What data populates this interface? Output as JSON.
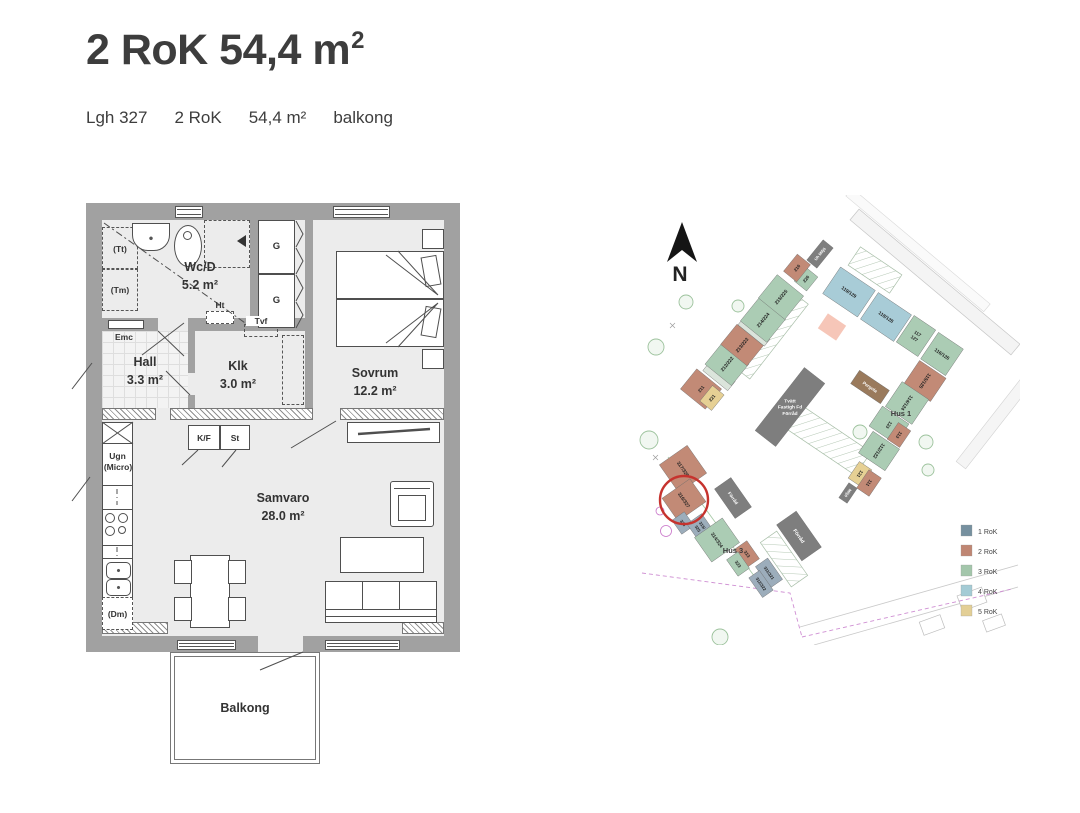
{
  "header": {
    "title_main": "2 RoK 54,4 m",
    "title_sup": "2",
    "meta": [
      "Lgh 327",
      "2 RoK",
      "54,4 m²",
      "balkong"
    ]
  },
  "floorplan": {
    "rooms": {
      "wcd": {
        "name": "Wc/D",
        "area": "5.2 m²"
      },
      "hall": {
        "name": "Hall",
        "area": "3.3 m²"
      },
      "klk": {
        "name": "Klk",
        "area": "3.0 m²"
      },
      "sovrum": {
        "name": "Sovrum",
        "area": "12.2 m²"
      },
      "samvaro": {
        "name": "Samvaro",
        "area": "28.0 m²"
      },
      "balkong": {
        "name": "Balkong"
      }
    },
    "labels": {
      "tt": "(Tt)",
      "tm": "(Tm)",
      "emc": "Emc",
      "ht": "Ht",
      "tvf": "Tvf",
      "g": "G",
      "kf": "K/F",
      "st": "St",
      "ugn": "Ugn",
      "micro": "(Micro)",
      "dm": "(Dm)"
    }
  },
  "siteplan": {
    "north": "N",
    "colors": {
      "rok1": "#9cadbb",
      "rok2": "#c28a76",
      "rok3": "#abccb4",
      "rok4": "#a8ccd7",
      "rok5": "#e6d094",
      "dark": "#7e7e7e",
      "pergola": "#9a7a5c",
      "connector": "#dbe4db"
    },
    "legend": [
      {
        "label": "1 RoK",
        "color": "#76909f"
      },
      {
        "label": "2 RoK",
        "color": "#bf8673"
      },
      {
        "label": "3 RoK",
        "color": "#a3c6ab"
      },
      {
        "label": "4 RoK",
        "color": "#a4cbd5"
      },
      {
        "label": "5 RoK",
        "color": "#e3cf96"
      }
    ],
    "area_labels": [
      {
        "text": "Hus 1",
        "x": 281,
        "y": 221
      },
      {
        "text": "Hus 3",
        "x": 113,
        "y": 358
      }
    ],
    "highlight": {
      "x": 64,
      "y": 305,
      "r": 24,
      "color": "#c6332e"
    },
    "buildings": [
      {
        "x": 81,
        "y": 194,
        "w": 26,
        "h": 32,
        "rot": -51,
        "c": "rok2",
        "lines": [
          "211"
        ],
        "fs": 4.5
      },
      {
        "x": 92,
        "y": 203,
        "w": 20,
        "h": 15,
        "rot": -51,
        "c": "rok5",
        "lines": [
          "221"
        ],
        "fs": 4.5
      },
      {
        "x": 99,
        "y": 181,
        "w": 12,
        "h": 32,
        "rot": -51,
        "c": "connector"
      },
      {
        "x": 107,
        "y": 169,
        "w": 28,
        "h": 34,
        "rot": -51,
        "c": "rok3",
        "lines": [
          "212/222"
        ],
        "fs": 4.8
      },
      {
        "x": 122,
        "y": 150,
        "w": 26,
        "h": 34,
        "rot": -51,
        "c": "rok2",
        "lines": [
          "213/223"
        ],
        "fs": 4.8
      },
      {
        "x": 134,
        "y": 137,
        "w": 9,
        "h": 34,
        "rot": -51,
        "c": "connector"
      },
      {
        "x": 143,
        "y": 125,
        "w": 30,
        "h": 34,
        "rot": -51,
        "c": "rok3",
        "lines": [
          "214/224"
        ],
        "fs": 4.8
      },
      {
        "x": 161,
        "y": 102,
        "w": 30,
        "h": 34,
        "rot": -51,
        "c": "rok3",
        "lines": [
          "215/225"
        ],
        "fs": 4.8
      },
      {
        "x": 186,
        "y": 84,
        "w": 18,
        "h": 16,
        "rot": -51,
        "c": "rok3",
        "lines": [
          "226"
        ],
        "fs": 4.5
      },
      {
        "x": 177,
        "y": 73,
        "w": 22,
        "h": 17,
        "rot": -51,
        "c": "rok2",
        "lines": [
          "216"
        ],
        "fs": 4.5
      },
      {
        "x": 200,
        "y": 59,
        "w": 26,
        "h": 13,
        "rot": -51,
        "c": "dark",
        "lines": [
          "Uh Miljö"
        ],
        "fs": 4,
        "tc": "#fff"
      },
      {
        "x": 229,
        "y": 97,
        "w": 42,
        "h": 32,
        "rot": 34,
        "c": "rok4",
        "lines": [
          "119/129"
        ],
        "fs": 4.8
      },
      {
        "x": 266,
        "y": 122,
        "w": 40,
        "h": 32,
        "rot": 34,
        "c": "rok4",
        "lines": [
          "118/128"
        ],
        "fs": 4.8
      },
      {
        "x": 296,
        "y": 141,
        "w": 26,
        "h": 32,
        "rot": 34,
        "c": "rok3",
        "lines": [
          "117",
          "127"
        ],
        "fs": 4.5
      },
      {
        "x": 322,
        "y": 159,
        "w": 30,
        "h": 32,
        "rot": 34,
        "c": "rok3",
        "lines": [
          "116/126"
        ],
        "fs": 4.8
      },
      {
        "x": 305,
        "y": 186,
        "w": 28,
        "h": 32,
        "rot": 124,
        "c": "rok2",
        "lines": [
          "115/125"
        ],
        "fs": 4.8
      },
      {
        "x": 287,
        "y": 208,
        "w": 30,
        "h": 32,
        "rot": 124,
        "c": "rok3",
        "lines": [
          "114/124"
        ],
        "fs": 4.8
      },
      {
        "x": 269,
        "y": 230,
        "w": 24,
        "h": 32,
        "rot": 124,
        "c": "rok3",
        "lines": [
          "123"
        ],
        "fs": 4.5
      },
      {
        "x": 279,
        "y": 240,
        "w": 20,
        "h": 15,
        "rot": 124,
        "c": "rok2",
        "lines": [
          "113"
        ],
        "fs": 4.5
      },
      {
        "x": 259,
        "y": 256,
        "w": 26,
        "h": 32,
        "rot": 124,
        "c": "rok3",
        "lines": [
          "112/122"
        ],
        "fs": 4.8
      },
      {
        "x": 240,
        "y": 279,
        "w": 20,
        "h": 15,
        "rot": 124,
        "c": "rok5",
        "lines": [
          "121"
        ],
        "fs": 4.5
      },
      {
        "x": 249,
        "y": 288,
        "w": 22,
        "h": 15,
        "rot": 124,
        "c": "rok2",
        "lines": [
          "111"
        ],
        "fs": 4.5
      },
      {
        "x": 228,
        "y": 298,
        "w": 18,
        "h": 10,
        "rot": 124,
        "c": "dark",
        "lines": [
          "Miljö"
        ],
        "fs": 4,
        "tc": "#fff"
      },
      {
        "x": 63,
        "y": 274,
        "w": 34,
        "h": 34,
        "rot": 55,
        "c": "rok2",
        "lines": [
          "317/328"
        ],
        "fs": 4.8
      },
      {
        "x": 64,
        "y": 305,
        "w": 28,
        "h": 34,
        "rot": 55,
        "c": "rok2",
        "lines": [
          "316/327"
        ],
        "fs": 4.8
      },
      {
        "x": 63,
        "y": 328,
        "w": 17,
        "h": 15,
        "rot": 55,
        "c": "rok1",
        "lines": [
          "326"
        ],
        "fs": 4.2
      },
      {
        "x": 80,
        "y": 332,
        "w": 20,
        "h": 18,
        "rot": 55,
        "c": "rok1",
        "lines": [
          "315/",
          "325"
        ],
        "fs": 4.2
      },
      {
        "x": 97,
        "y": 345,
        "w": 30,
        "h": 34,
        "rot": 55,
        "c": "rok3",
        "lines": [
          "314/324"
        ],
        "fs": 4.8
      },
      {
        "x": 127,
        "y": 359,
        "w": 22,
        "h": 15,
        "rot": 55,
        "c": "rok2",
        "lines": [
          "313"
        ],
        "fs": 4.5
      },
      {
        "x": 118,
        "y": 369,
        "w": 20,
        "h": 14,
        "rot": 55,
        "c": "rok3",
        "lines": [
          "323"
        ],
        "fs": 4.5
      },
      {
        "x": 149,
        "y": 378,
        "w": 26,
        "h": 15,
        "rot": 55,
        "c": "rok1",
        "lines": [
          "311/321"
        ],
        "fs": 4.2
      },
      {
        "x": 141,
        "y": 389,
        "w": 24,
        "h": 13,
        "rot": 55,
        "c": "rok1",
        "lines": [
          "312/322"
        ],
        "fs": 4.2
      },
      {
        "x": 113,
        "y": 303,
        "w": 36,
        "h": 20,
        "rot": 55,
        "c": "dark",
        "lines": [
          "Förråd"
        ],
        "fs": 4.5,
        "tc": "#fff"
      },
      {
        "x": 179,
        "y": 341,
        "w": 44,
        "h": 24,
        "rot": 55,
        "c": "dark",
        "lines": [
          "Förråd"
        ],
        "fs": 5,
        "tc": "#fff"
      },
      {
        "x": 170,
        "y": 212,
        "w": 80,
        "h": 26,
        "rot": -52,
        "c": "dark",
        "lines": [
          "Tvätt",
          "Fastigh Fd",
          "Förråd"
        ],
        "fs": 4.8,
        "tc": "#fff",
        "lr": 0
      },
      {
        "x": 250,
        "y": 192,
        "w": 36,
        "h": 16,
        "rot": 34,
        "c": "pergola",
        "lines": [
          "Pergola"
        ],
        "fs": 4.5,
        "tc": "#fff"
      }
    ]
  }
}
